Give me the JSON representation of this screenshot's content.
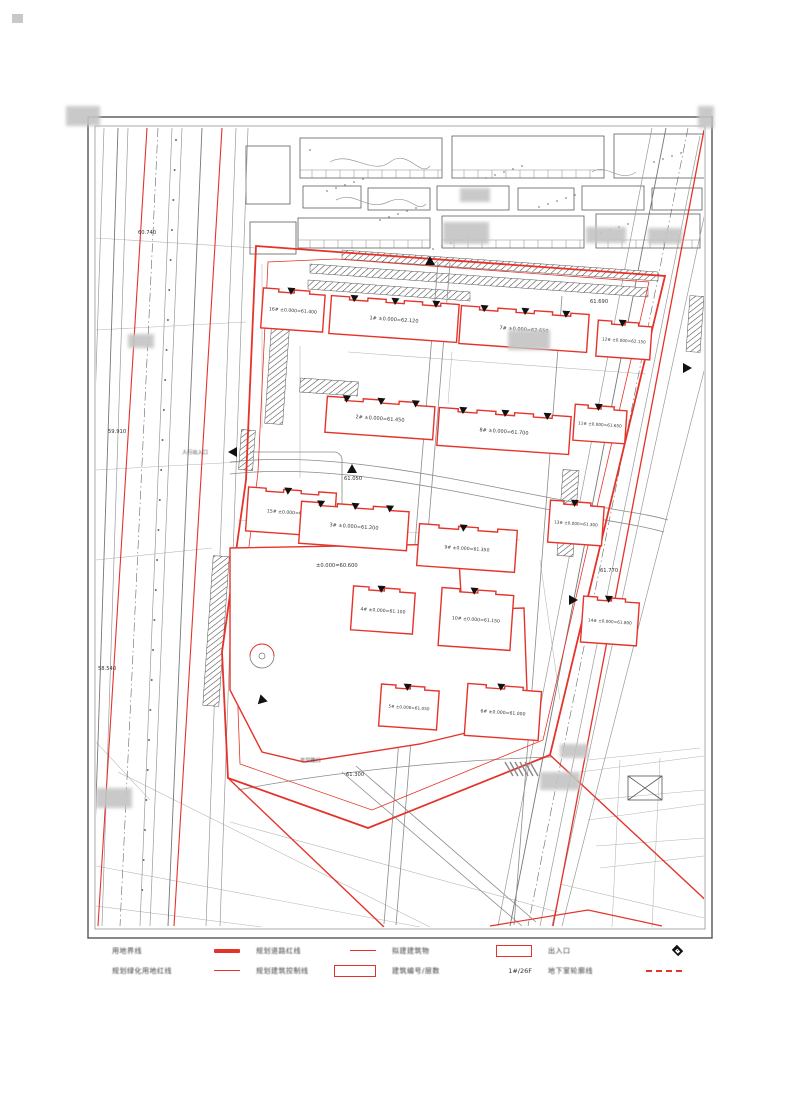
{
  "legend": {
    "items": [
      {
        "label": "用地界线",
        "symbol": "thick-red-line"
      },
      {
        "label": "规划道路红线",
        "symbol": "thin-red-line"
      },
      {
        "label": "拟建建筑物",
        "symbol": "red-rect"
      },
      {
        "label": "出入口",
        "symbol": "entrance-diamond"
      },
      {
        "label": "规划绿化用地红线",
        "symbol": "thin-red-line"
      },
      {
        "label": "规划建筑控制线",
        "symbol": "red-rect-outline"
      },
      {
        "label": "建筑编号/层数",
        "symbol": "text",
        "value": "1#/26F"
      },
      {
        "label": "地下室轮廓线",
        "symbol": "red-dashed-line"
      }
    ]
  },
  "buildings": [
    {
      "id": "16#",
      "label": "16# ±0.000=61.400"
    },
    {
      "id": "1#",
      "label": "1# ±0.000=62.120"
    },
    {
      "id": "7#",
      "label": "7# ±0.000=62.650"
    },
    {
      "id": "12#",
      "label": "12# ±0.000=62.150"
    },
    {
      "id": "2#",
      "label": "2# ±0.000=61.450"
    },
    {
      "id": "8#",
      "label": "8# ±0.000=61.700"
    },
    {
      "id": "11#",
      "label": "11# ±0.000=61.650"
    },
    {
      "id": "15#",
      "label": "15# ±0.000=61.250"
    },
    {
      "id": "3#",
      "label": "3# ±0.000=61.200"
    },
    {
      "id": "9#",
      "label": "9# ±0.000=61.350"
    },
    {
      "id": "13#",
      "label": "13# ±0.000=61.300"
    },
    {
      "id": "4#",
      "label": "4# ±0.000=61.100"
    },
    {
      "id": "10#",
      "label": "10# ±0.000=61.150"
    },
    {
      "id": "14#",
      "label": "14# ±0.000=61.800"
    },
    {
      "id": "5#",
      "label": "5# ±0.000=61.050"
    },
    {
      "id": "6#",
      "label": "6# ±0.000=61.000"
    }
  ],
  "site": {
    "large_plot_label": "±0.000=60.600"
  },
  "annotations": {
    "pedestrian_entrance": "人行出入口",
    "level_crossing": "平交路口",
    "spot_elevations": [
      "60.740",
      "59.910",
      "58.540",
      "61.050",
      "61.300",
      "61.690",
      "61.770"
    ]
  },
  "colors": {
    "redline": "#e5332a",
    "linework": "#555555"
  }
}
